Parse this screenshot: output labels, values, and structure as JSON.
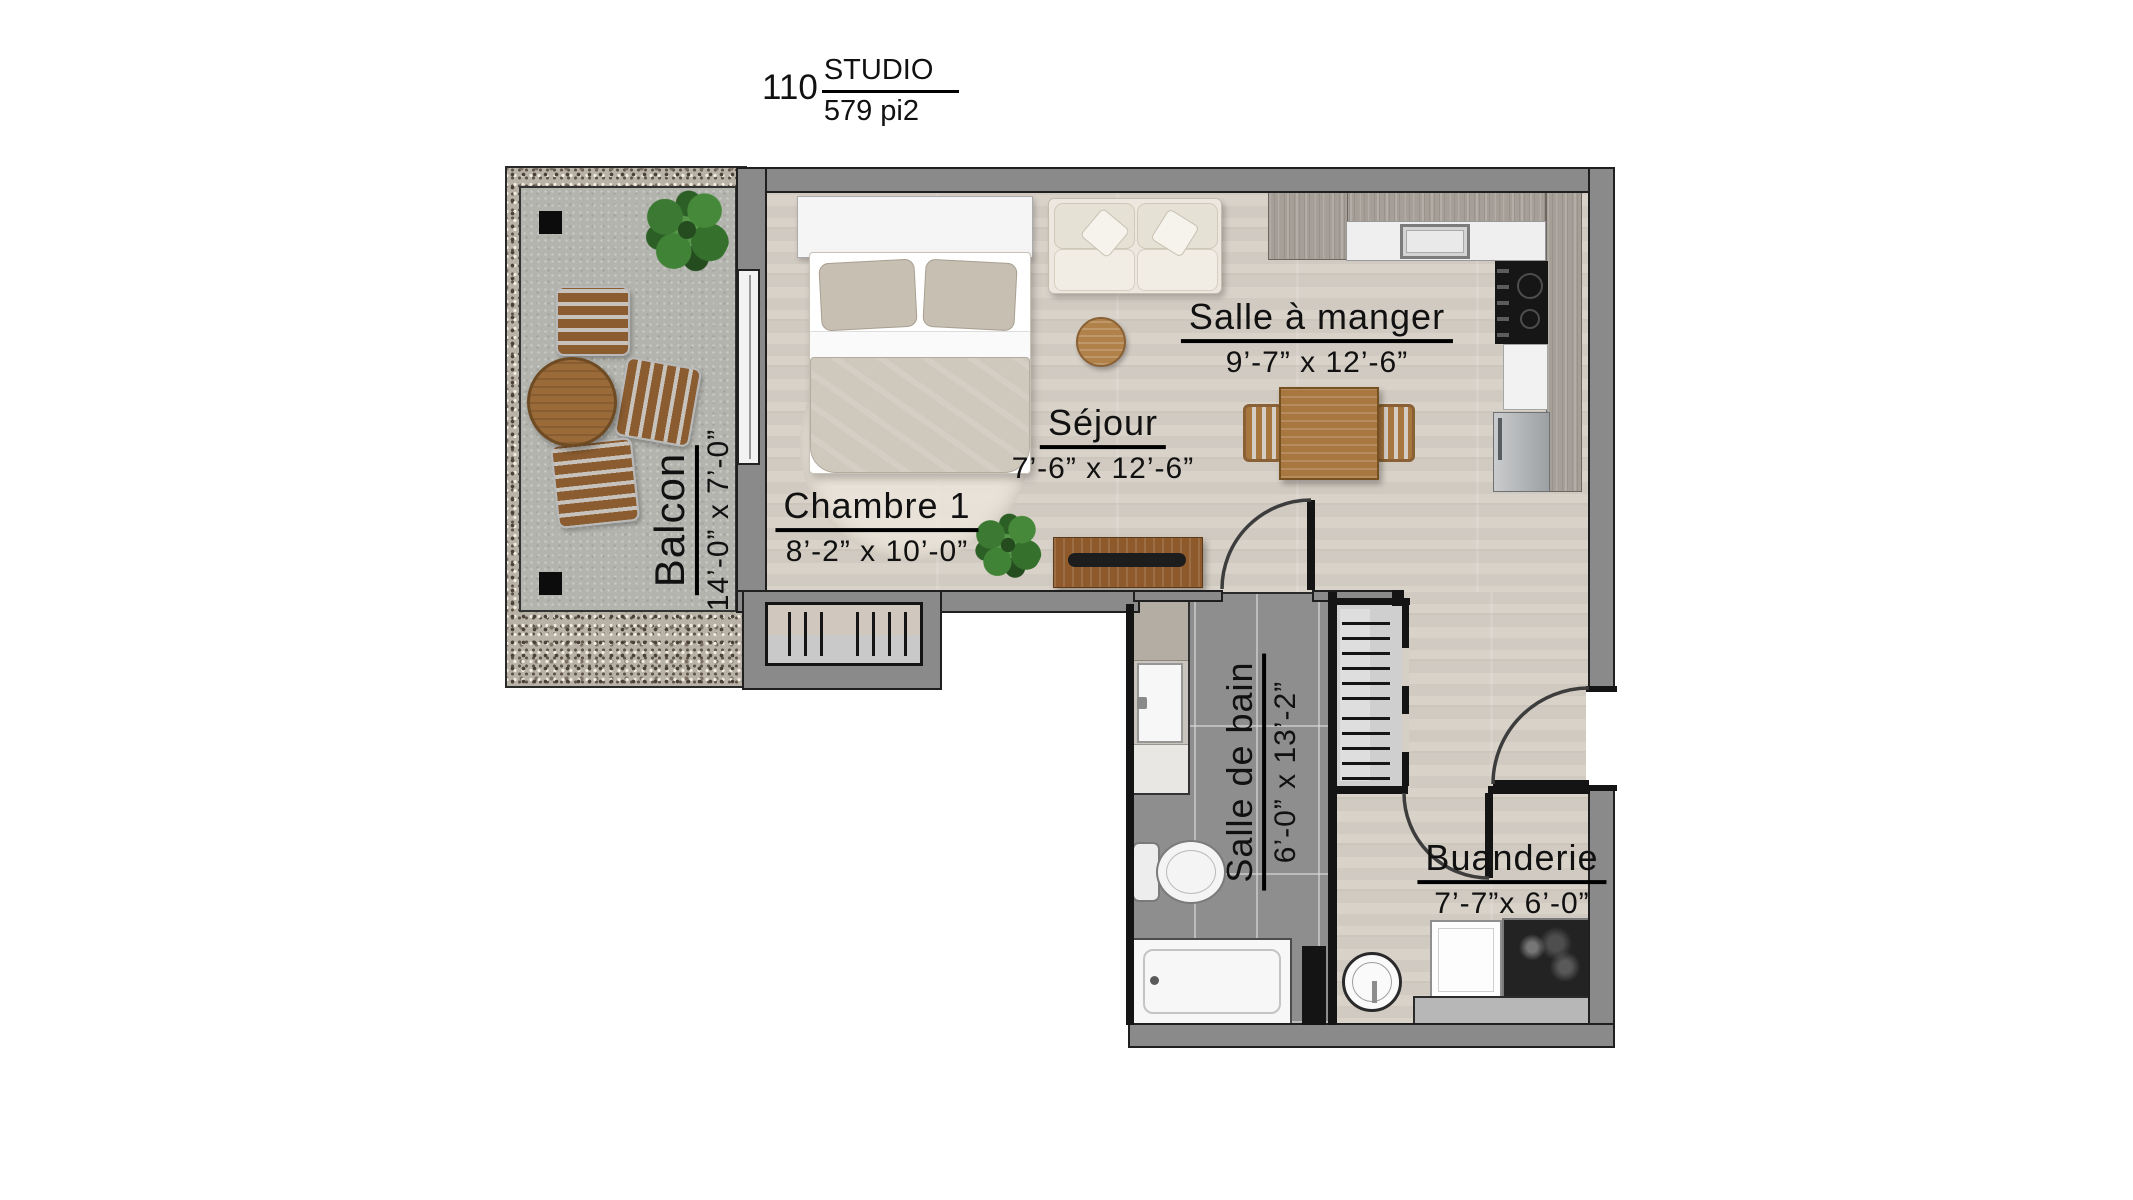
{
  "title": {
    "unit_number": "110",
    "unit_type": "STUDIO",
    "unit_area": "579 pi2"
  },
  "rooms": {
    "chambre1": {
      "name": "Chambre 1",
      "dims": "8’-2” x 10’-0”"
    },
    "sejour": {
      "name": "Séjour",
      "dims": "7’-6” x 12’-6”"
    },
    "salle_a_manger": {
      "name": "Salle à manger",
      "dims": "9’-7” x 12’-6”"
    },
    "balcon": {
      "name": "Balcon",
      "dims": "14’-0” x 7’-0”"
    },
    "salle_de_bain": {
      "name": "Salle de bain",
      "dims": "6’-0” x 13’-2”"
    },
    "buanderie": {
      "name": "Buanderie",
      "dims": "7’-7”x 6’-0”"
    }
  },
  "colors": {
    "wall_gray": "#8a8a8a",
    "outline_black": "#1f1f1f",
    "wood_floor": "#d6cfc6",
    "tile_floor": "#8e8e8e",
    "balcony_concrete": "#b3b4ae",
    "gravel": "#b9b2a6",
    "furniture_wood": "#a8763f",
    "label_text": "#111111"
  },
  "symbols": [
    "bed",
    "headboard",
    "pillow",
    "round-rug",
    "sofa",
    "throw-pillow",
    "coffee-table",
    "tv-console",
    "soundbar",
    "plant",
    "dining-table",
    "dining-chair",
    "kitchen-counter",
    "kitchen-sink",
    "cooktop",
    "dishwasher",
    "refrigerator",
    "vanity-sink",
    "toilet",
    "bathtub",
    "closet-rod-ticks",
    "door-swing-arc",
    "sliding-door",
    "washer",
    "laundry-sink",
    "water-heater",
    "patio-chair",
    "patio-table",
    "balcony-post"
  ]
}
